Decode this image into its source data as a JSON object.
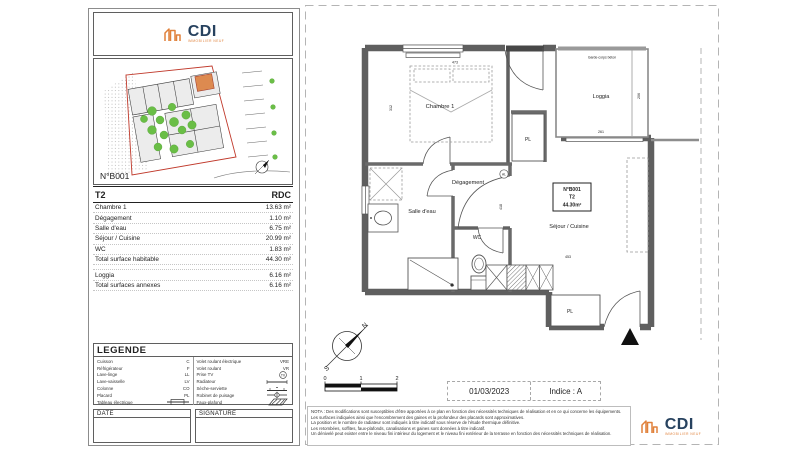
{
  "brand": {
    "name": "CDI",
    "tagline": "IMMOBILIER NEUF",
    "orange": "#E0813B",
    "navy": "#27425F"
  },
  "left_panel": {
    "site_plan": {
      "unit_label": "N°B001"
    },
    "summary": {
      "type": "T2",
      "level": "RDC",
      "rows": [
        {
          "label": "Chambre 1",
          "value": "13.63 m²"
        },
        {
          "label": "Dégagement",
          "value": "1.10 m²"
        },
        {
          "label": "Salle d'eau",
          "value": "6.75 m²"
        },
        {
          "label": "Séjour / Cuisine",
          "value": "20.99 m²"
        },
        {
          "label": "WC",
          "value": "1.83 m²"
        },
        {
          "label": "Total surface habitable",
          "value": "44.30 m²"
        }
      ],
      "annex_rows": [
        {
          "label": "Loggia",
          "value": "6.16 m²"
        },
        {
          "label": "Total surfaces annexes",
          "value": "6.16 m²"
        }
      ]
    },
    "legend": {
      "title": "LEGENDE",
      "tv_label": "TV",
      "left": [
        {
          "label": "Cuisson",
          "code": "C"
        },
        {
          "label": "Réfrigérateur",
          "code": "F"
        },
        {
          "label": "Lave-linge",
          "code": "LL"
        },
        {
          "label": "Lave-vaisselle",
          "code": "LV"
        },
        {
          "label": "Colonne",
          "code": "CO"
        },
        {
          "label": "Placard",
          "code": "PL"
        },
        {
          "label": "Tableau électrique",
          "code": ""
        }
      ],
      "right": [
        {
          "label": "Volet roulant électrique",
          "code": "VRE"
        },
        {
          "label": "Volet roulant",
          "code": "VR"
        },
        {
          "label": "Prise TV",
          "code": ""
        },
        {
          "label": "Radiateur",
          "code": ""
        },
        {
          "label": "Sèche-serviette",
          "code": ""
        },
        {
          "label": "Robinet de puisage",
          "code": ""
        },
        {
          "label": "Faux-plafond",
          "code": ""
        }
      ]
    },
    "date_label": "DATE",
    "signature_label": "SIGNATURE"
  },
  "plan": {
    "rooms": {
      "chambre": "Chambre 1",
      "degagement": "Dégagement",
      "salle_deau": "Salle d'eau",
      "wc": "WC",
      "sejour": "Séjour / Cuisine",
      "loggia": "Loggia",
      "placard": "PL",
      "garde_corps": "Garde-corps béton",
      "vent": "AL"
    },
    "unit_tag": {
      "number": "N°B001",
      "type": "T2",
      "area": "44.30m²"
    },
    "dims": {
      "chambre_w": "473",
      "chambre_h": "312",
      "hall_h": "418",
      "sejour_w": "453",
      "loggia_w": "261",
      "loggia_h": "206"
    },
    "compass": {
      "north": "N",
      "south": "S"
    },
    "scale_ticks": [
      "0",
      "1",
      "2"
    ],
    "title_block": {
      "date": "01/03/2023",
      "indice": "Indice : A"
    }
  },
  "nota": {
    "lines": [
      "NOTA : Des modifications sont susceptibles d'être apportées à ce plan en fonction des nécessités techniques de réalisation et en ce qui concerne les équipements.",
      "Les surfaces indiquées ainsi que l'encombrement des gaines et la profondeur des placards sont approximatives.",
      "La position et le nombre de radiateur sont indiqués à titre indicatif sous réserve de l'étude thermique définitive.",
      "Les retombées, soffites, faux-plafonds, canalisations et gaines sont données à titre indicatif.",
      "Un dénivelé peut exister entre le niveau fini intérieur du logement et le niveau fini extérieur de la terrasse en fonction des nécessités techniques de réalisation."
    ]
  }
}
